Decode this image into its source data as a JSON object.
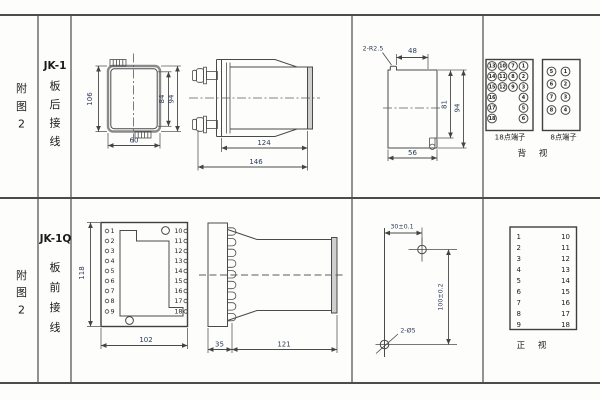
{
  "sheet": {
    "row1": {
      "fig_label": [
        "附",
        "图",
        "2"
      ],
      "model": "JK-1",
      "wiring": [
        "板",
        "后",
        "接",
        "线"
      ],
      "rear_dims": {
        "overall_h": "106",
        "inner_h": "84",
        "outer_h": "94",
        "width": "60"
      },
      "side_dims": {
        "body_len": "124",
        "total_len": "146"
      },
      "cutout": {
        "slots": "2-R2.5",
        "top_w": "48",
        "inner_h": "81",
        "outer_h": "94",
        "bottom_w": "56"
      },
      "t18": {
        "label": "18点端子",
        "cells": [
          "13",
          "10",
          "7",
          "1",
          "14",
          "11",
          "8",
          "2",
          "15",
          "12",
          "9",
          "3",
          "16",
          "4",
          "17",
          "5",
          "18",
          "6"
        ]
      },
      "t8": {
        "label": "8点端子",
        "cells": [
          "5",
          "1",
          "6",
          "2",
          "7",
          "3",
          "8",
          "4"
        ]
      },
      "view_label": "背 视"
    },
    "row2": {
      "fig_label": [
        "附",
        "图",
        "2"
      ],
      "model": "JK-1Q",
      "wiring": [
        "板",
        "前",
        "接",
        "线"
      ],
      "front": {
        "left": [
          "1",
          "2",
          "3",
          "4",
          "5",
          "6",
          "7",
          "8",
          "9"
        ],
        "right": [
          "10",
          "11",
          "12",
          "13",
          "14",
          "15",
          "16",
          "17",
          "18"
        ],
        "height": "118",
        "width": "102"
      },
      "side_dims": {
        "plate": "35",
        "body": "121"
      },
      "drill": {
        "spacing_h": "30±0.1",
        "spacing_v": "100±0.2",
        "holes": "2-Ø5"
      },
      "table": {
        "left": [
          "1",
          "2",
          "3",
          "4",
          "5",
          "6",
          "7",
          "8",
          "9"
        ],
        "right": [
          "10",
          "11",
          "12",
          "13",
          "14",
          "15",
          "16",
          "17",
          "18"
        ],
        "view_label": "正 视"
      }
    }
  }
}
